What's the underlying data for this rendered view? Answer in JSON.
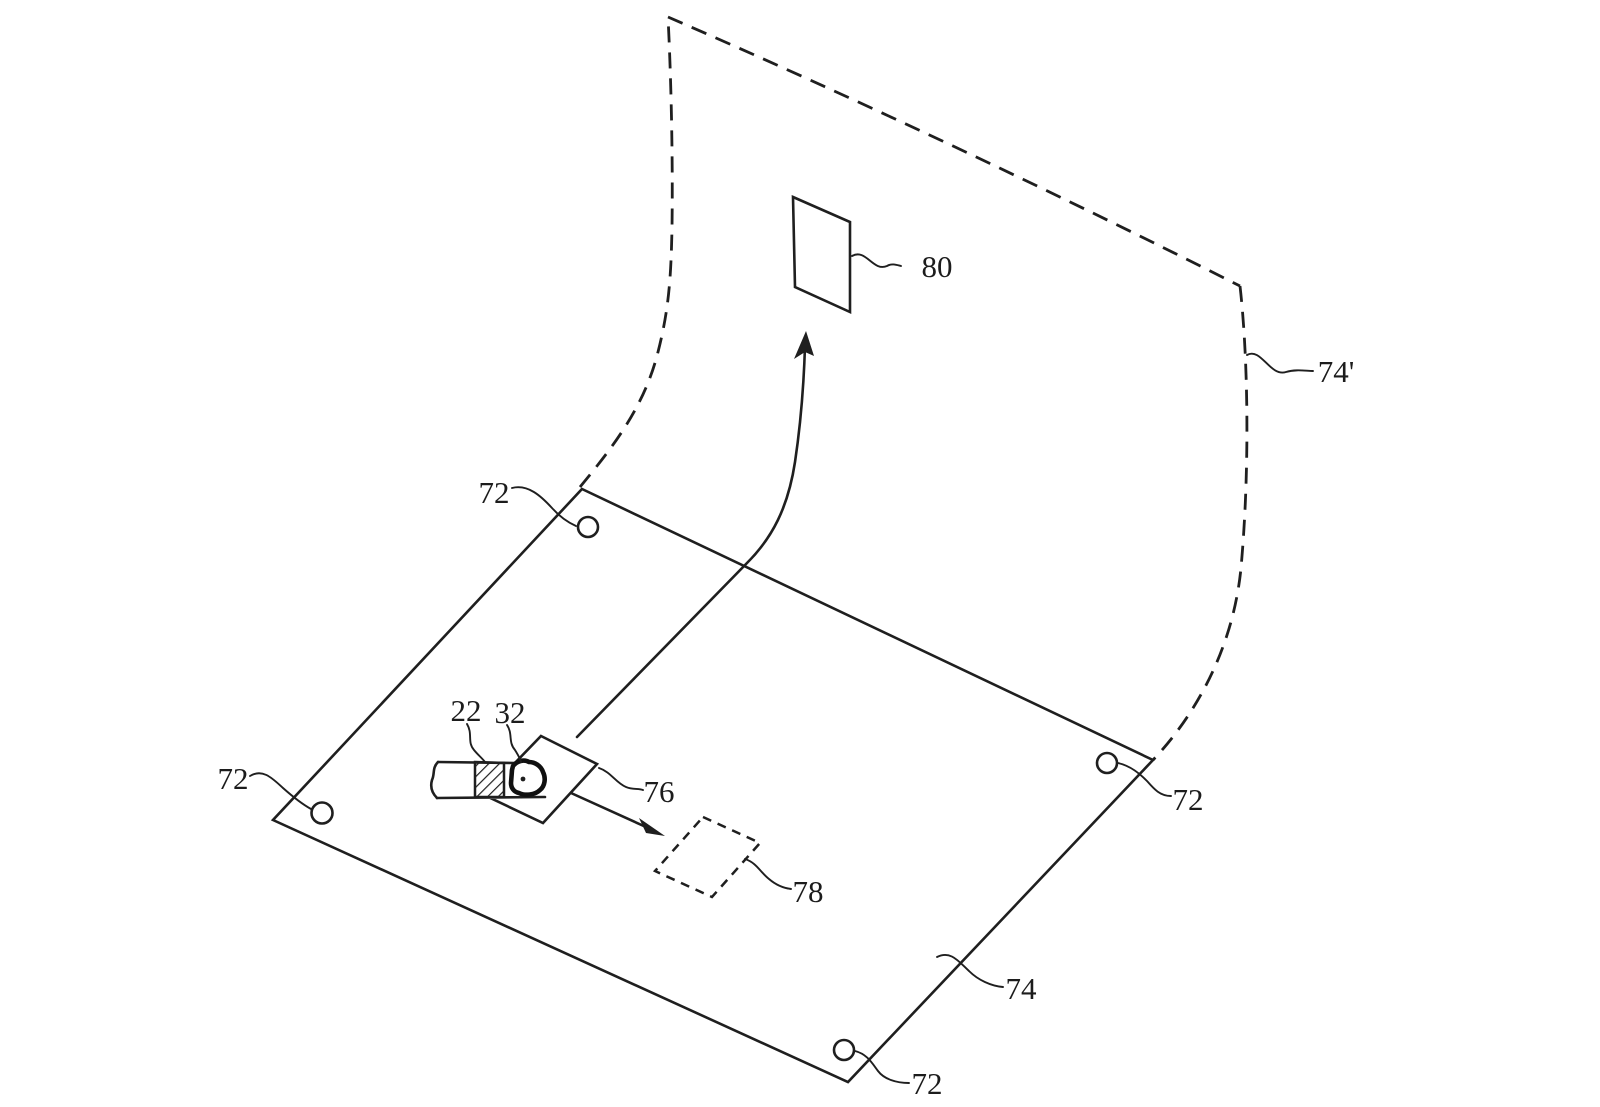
{
  "figure": {
    "kind": "patent-line-drawing",
    "description": "Isometric patent-style figure: flat flexible substrate sheet with corner holes, a curled dashed copy of the sheet rising behind it, a finger-mounted device on a small square platform, a dashed target outline on the sheet, and a raised target patch on the curled sheet with transfer arrows.",
    "colors": {
      "ink": "#1f1f1f",
      "background": "#ffffff"
    }
  },
  "labels": {
    "finger_band": "22",
    "fingertip_device": "32",
    "hole_top": "72",
    "hole_left": "72",
    "hole_right": "72",
    "hole_bottom": "72",
    "substrate_flat": "74",
    "substrate_curled": "74'",
    "device_platform": "76",
    "target_outline": "78",
    "raised_patch": "80"
  }
}
